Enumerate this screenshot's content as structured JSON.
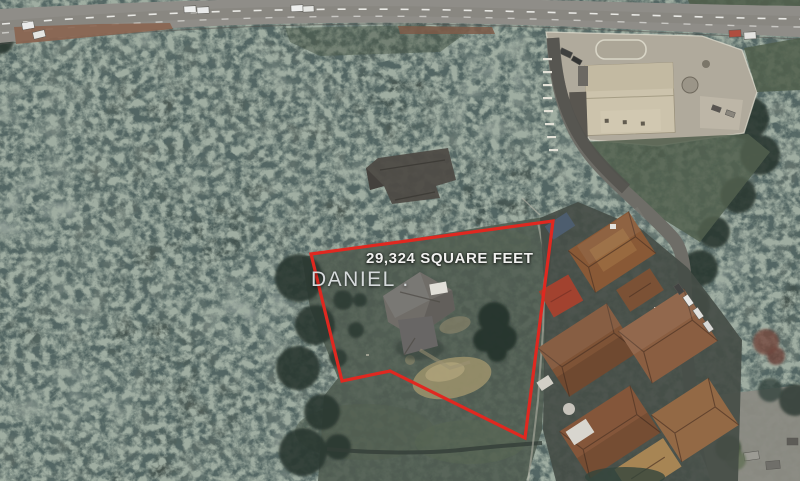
{
  "annotations": {
    "area_label": "29,324 SQUARE FEET",
    "owner_label": "DANIEL .",
    "outline_color": "#e02820",
    "outline_points": "311,254 553,221 525,438 390,371 342,381"
  }
}
